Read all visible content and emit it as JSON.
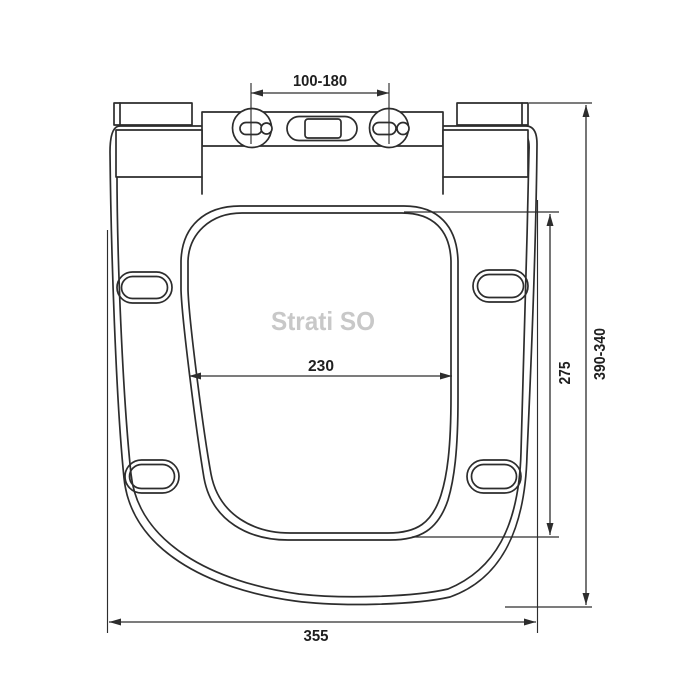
{
  "drawing": {
    "watermark": "Strati SO",
    "dimensions": {
      "hinge_spacing": "100-180",
      "opening_width": "230",
      "opening_depth": "275",
      "seat_length_range": "390-340",
      "seat_width": "355"
    },
    "colors": {
      "line": "#2d2d2d",
      "dimension_text": "#1f1f1f",
      "watermark": "#c8c8c8",
      "background": "#ffffff"
    }
  }
}
